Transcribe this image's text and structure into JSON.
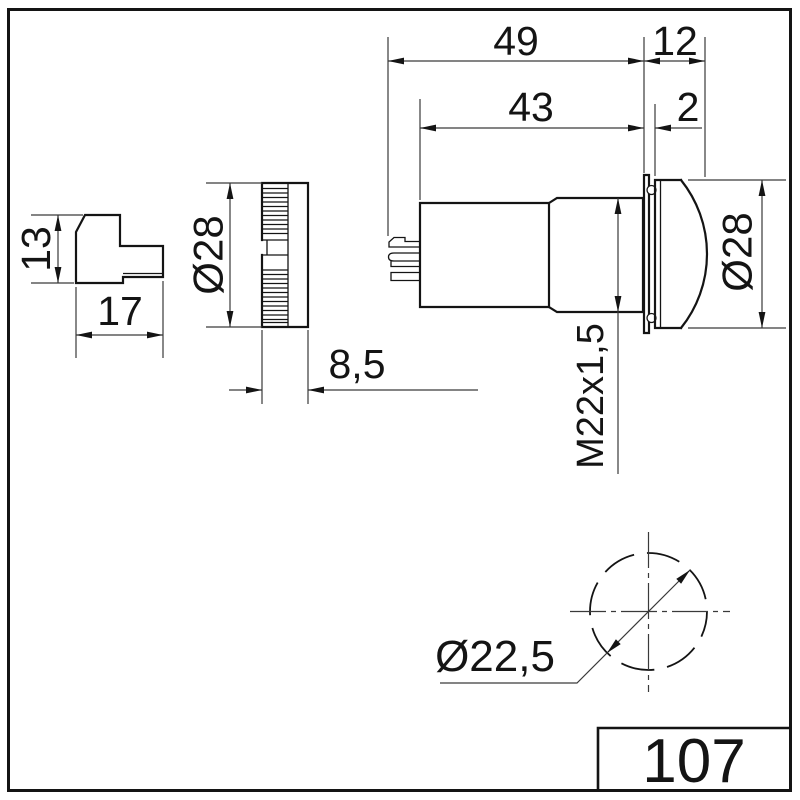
{
  "colors": {
    "line": "#141414",
    "background": "#ffffff"
  },
  "dims": {
    "overall_length": "49",
    "front_length": "12",
    "body_length": "43",
    "bezel_offset": "2",
    "connector_height": "13",
    "connector_length": "17",
    "cap_diameter": "Ø28",
    "cap_depth": "8,5",
    "thread_size": "M22x1,5",
    "lens_diameter": "Ø28",
    "mounting_hole_diameter": "Ø22,5"
  },
  "title_block": {
    "part_number": "107"
  }
}
